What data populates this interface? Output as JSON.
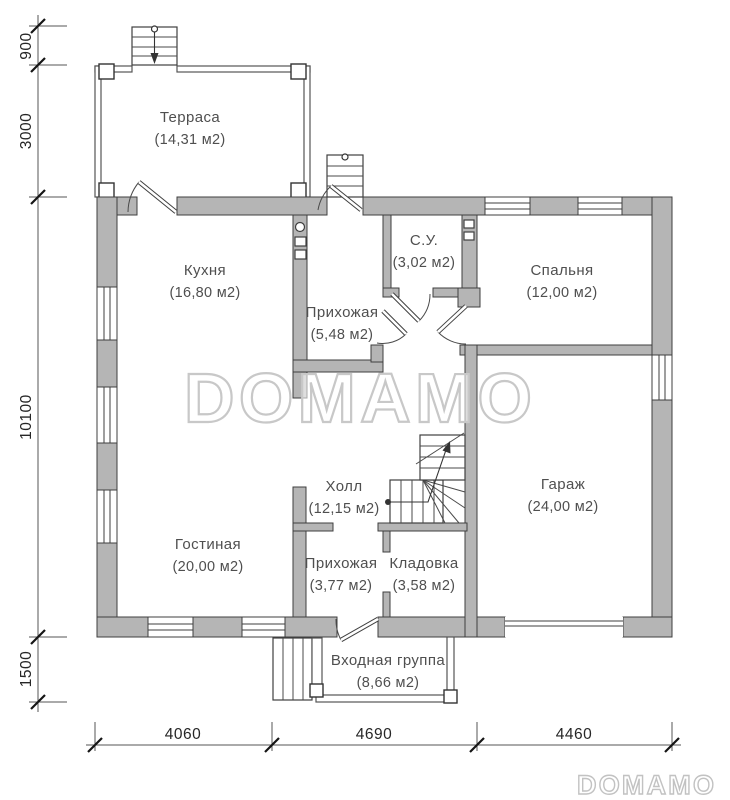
{
  "watermark": {
    "main": "DOMAMO",
    "corner": "DOMAMO"
  },
  "rooms": {
    "terrace": {
      "name": "Терраса",
      "area": "(14,31 м2)"
    },
    "kitchen": {
      "name": "Кухня",
      "area": "(16,80 м2)"
    },
    "hallway_top": {
      "name": "Прихожая",
      "area": "(5,48 м2)"
    },
    "bathroom": {
      "name": "С.У.",
      "area": "(3,02 м2)"
    },
    "bedroom": {
      "name": "Спальня",
      "area": "(12,00 м2)"
    },
    "hall": {
      "name": "Холл",
      "area": "(12,15 м2)"
    },
    "living_room": {
      "name": "Гостиная",
      "area": "(20,00 м2)"
    },
    "hallway_bottom": {
      "name": "Прихожая",
      "area": "(3,77 м2)"
    },
    "storage": {
      "name": "Кладовка",
      "area": "(3,58 м2)"
    },
    "garage": {
      "name": "Гараж",
      "area": "(24,00 м2)"
    },
    "entrance": {
      "name": "Входная группа",
      "area": "(8,66 м2)"
    }
  },
  "dimensions": {
    "left": {
      "d900": "900",
      "d3000": "3000",
      "d10100": "10100",
      "d1500": "1500"
    },
    "bottom": {
      "d4060": "4060",
      "d4690": "4690",
      "d4460": "4460"
    }
  },
  "colors": {
    "wall_fill": "#b5b5b5",
    "wall_stroke": "#3f3f3f",
    "line": "#4a4a4a",
    "text": "#4f4f4f",
    "watermark": "#c8c8c8",
    "background": "#ffffff"
  }
}
